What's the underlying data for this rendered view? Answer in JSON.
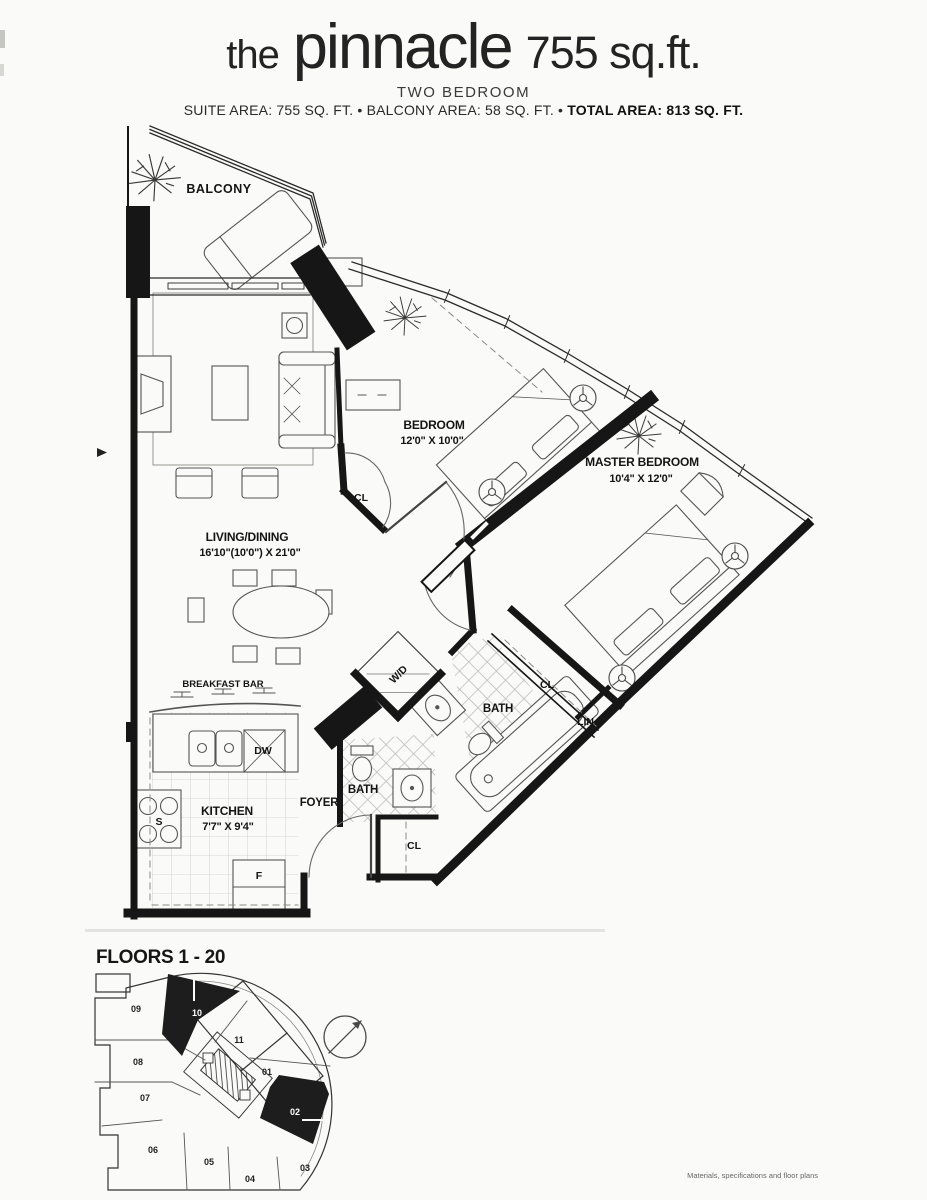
{
  "header": {
    "title_prefix": "the",
    "title_name": "pinnacle",
    "title_size": "755 sq.ft.",
    "subtitle": "TWO BEDROOM",
    "areas_left": "SUITE AREA: 755 SQ. FT. • BALCONY AREA: 58 SQ. FT. •",
    "areas_total": "TOTAL AREA: 813 SQ. FT."
  },
  "plan": {
    "balcony_label": "BALCONY",
    "living": {
      "name": "LIVING/DINING",
      "dims": "16'10\"(10'0\") X 21'0\""
    },
    "bedroom": {
      "name": "BEDROOM",
      "dims": "12'0\" X 10'0\""
    },
    "master_bedroom": {
      "name": "MASTER BEDROOM",
      "dims": "10'4\" X 12'0\""
    },
    "kitchen": {
      "name": "KITCHEN",
      "dims": "7'7\" X 9'4\""
    },
    "breakfast_bar_label": "BREAKFAST BAR",
    "foyer_label": "FOYER",
    "bath_label": "BATH",
    "bath2_label": "BATH",
    "washer_dryer_label": "W/D",
    "dishwasher_label": "DW",
    "stove_label": "S",
    "fridge_label": "F",
    "closet_label": "CL",
    "closet2_label": "CL",
    "closet3_label": "CL",
    "linen_label": "LIN."
  },
  "keyplan": {
    "title": "FLOORS 1 - 20",
    "units": [
      "01",
      "02",
      "03",
      "04",
      "05",
      "06",
      "07",
      "08",
      "09",
      "10",
      "11"
    ],
    "highlighted_units": [
      "02",
      "10"
    ]
  },
  "footer": {
    "fine_print": "Materials, specifications and floor plans"
  }
}
